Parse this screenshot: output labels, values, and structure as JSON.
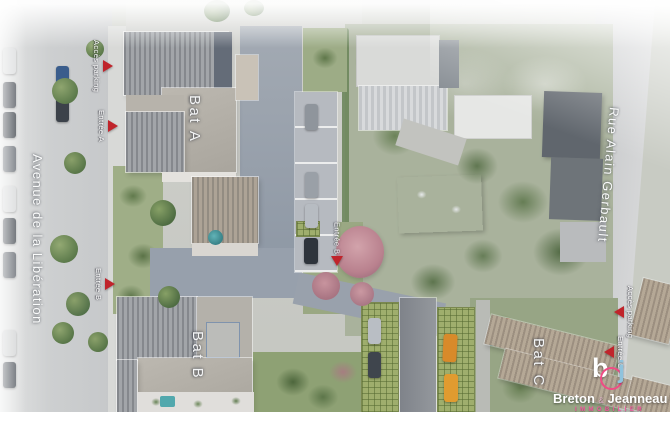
{
  "streets": {
    "left_name": "Avenue de la Libération",
    "right_name": "Rue Alain Gerbault"
  },
  "buildings": {
    "bat_a": "Bat A",
    "bat_b": "Bat B",
    "bat_c": "Bat C"
  },
  "markers": {
    "access_parking_west": "Accès parking",
    "entree_a": "Entrée A",
    "entree_b_west": "Entrée B",
    "entree_b_court": "Entrée B",
    "access_parking_east": "Accès parking",
    "entree_c": "Entrée C"
  },
  "logo": {
    "monogram_b": "b",
    "monogram_j": "j",
    "name_first": "Breton",
    "ampersand": "&",
    "name_second": "Jeanneau",
    "tagline": "IMMOBILIER"
  },
  "colors": {
    "marker_red": "#c0242b",
    "logo_pink": "#ef4d85",
    "logo_blue": "#8fc3dd"
  }
}
